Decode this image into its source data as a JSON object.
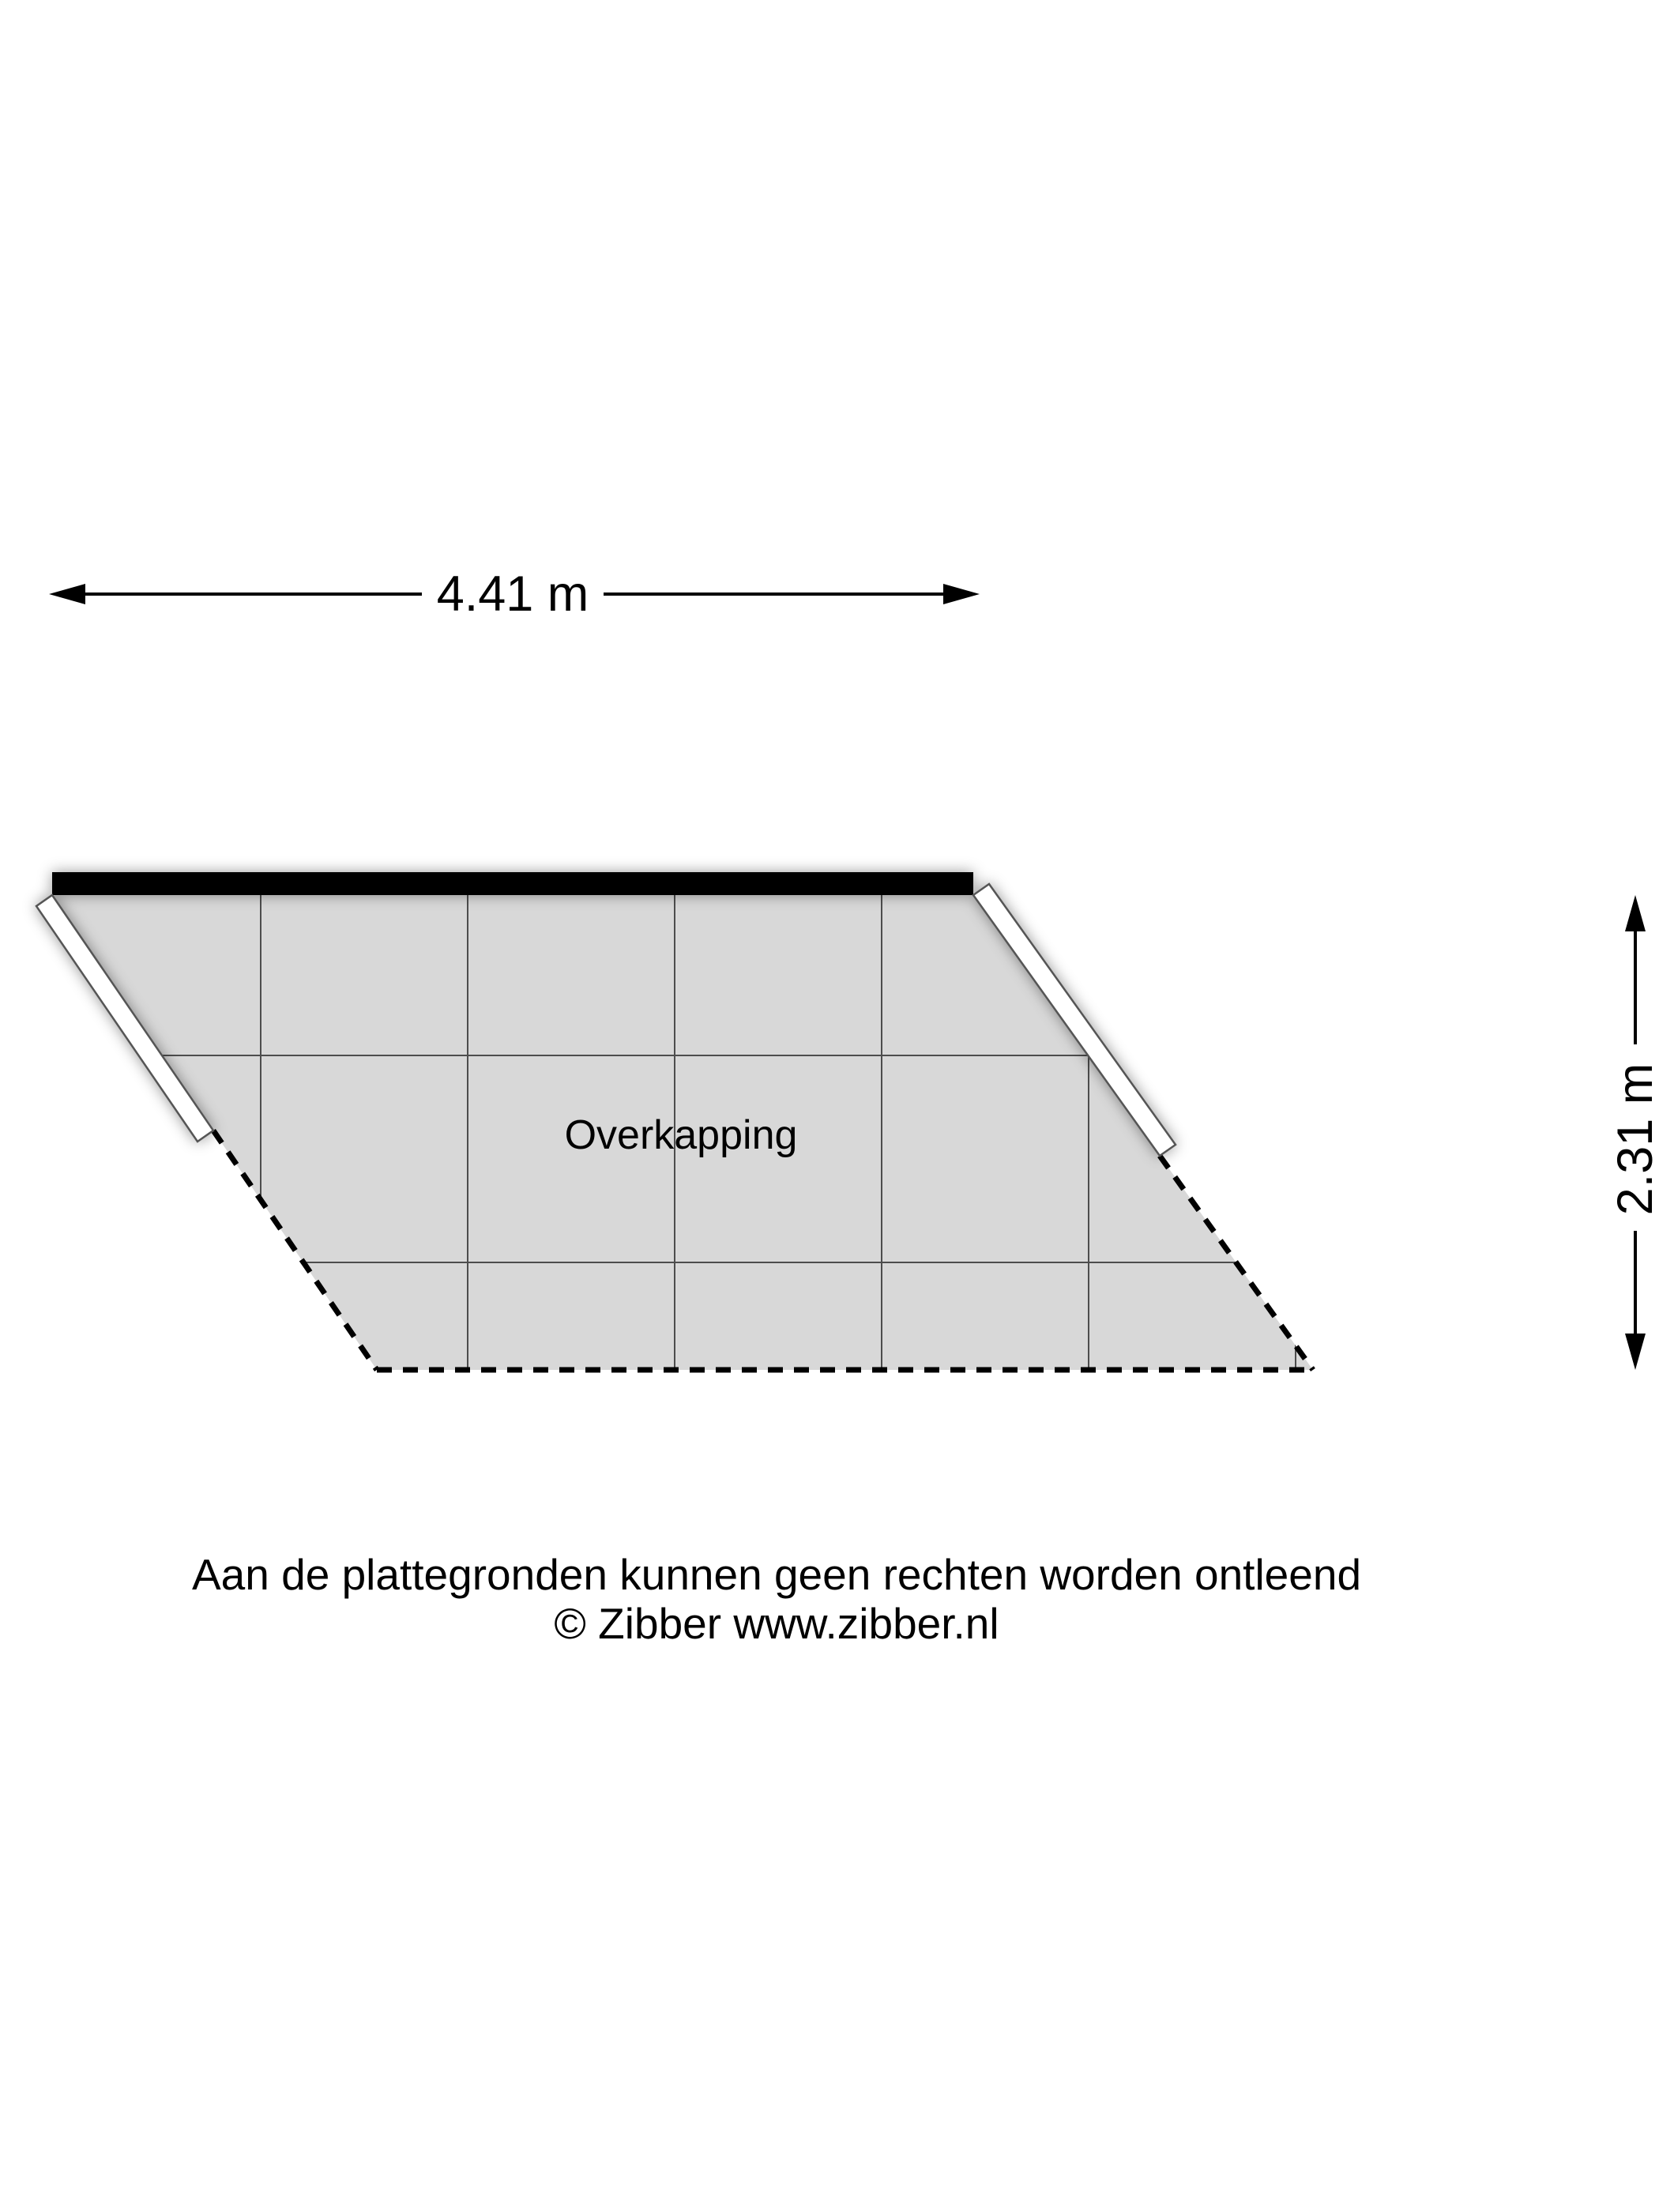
{
  "plan": {
    "room_label": "Overkapping",
    "width_dimension": "4.41 m",
    "height_dimension": "2.31 m"
  },
  "footer": {
    "disclaimer": "Aan de plattegronden kunnen geen rechten worden ontleend",
    "copyright": "© Zibber www.zibber.nl"
  },
  "colors": {
    "floor": "#d8d8d8",
    "grid": "#4d4d4d",
    "wall": "#000000",
    "open_wall": "#ffffff",
    "outline": "#555555",
    "dash": "#000000",
    "text": "#000000"
  }
}
